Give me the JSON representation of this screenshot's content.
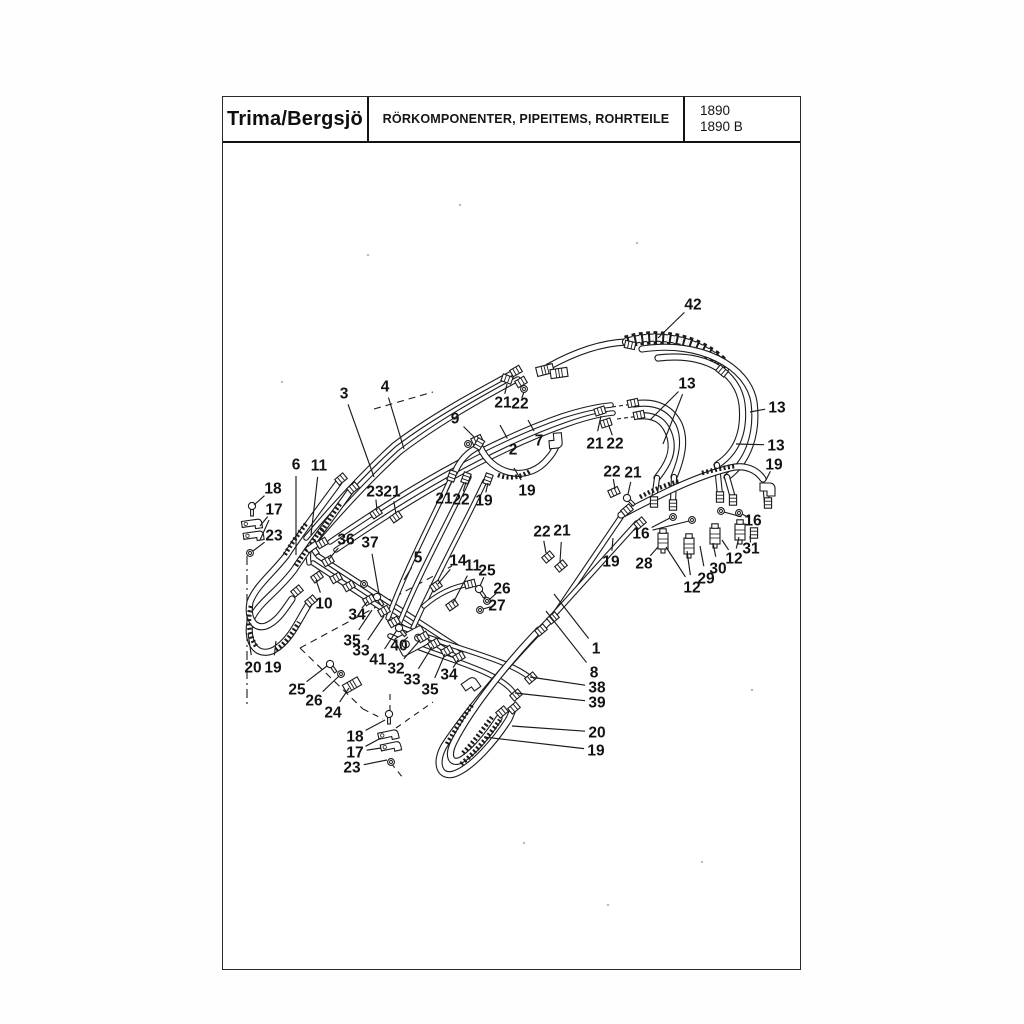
{
  "header": {
    "brand": "Trima/Bergsjö",
    "title": "RÖRKOMPONENTER, PIPEITEMS, ROHRTEILE",
    "model_line1": "1890",
    "model_line2": "1890 B"
  },
  "figure": {
    "description": "Exploded diagram of hydraulic pipe components (pipes, hoses, fittings) with numbered callouts",
    "callouts": [
      {
        "n": "42",
        "x": 693,
        "y": 304,
        "to": [
          [
            658,
            338
          ]
        ]
      },
      {
        "n": "3",
        "x": 344,
        "y": 393,
        "to": [
          [
            374,
            477
          ]
        ]
      },
      {
        "n": "4",
        "x": 385,
        "y": 386,
        "to": [
          [
            404,
            449
          ]
        ]
      },
      {
        "n": "13",
        "x": 687,
        "y": 383,
        "to": [
          [
            650,
            420
          ],
          [
            663,
            444
          ]
        ]
      },
      {
        "n": "13",
        "x": 777,
        "y": 407,
        "to": [
          [
            750,
            412
          ]
        ]
      },
      {
        "n": "13",
        "x": 776,
        "y": 445,
        "to": [
          [
            736,
            444
          ]
        ]
      },
      {
        "n": "19",
        "x": 774,
        "y": 464,
        "to": [
          [
            766,
            480
          ]
        ]
      },
      {
        "n": "21",
        "x": 503,
        "y": 402,
        "to": [
          [
            507,
            384
          ]
        ]
      },
      {
        "n": "22",
        "x": 520,
        "y": 403,
        "to": [
          [
            524,
            392
          ]
        ]
      },
      {
        "n": "9",
        "x": 455,
        "y": 418,
        "to": [
          [
            474,
            437
          ]
        ]
      },
      {
        "n": "2",
        "x": 513,
        "y": 449,
        "to": [
          [
            500,
            425
          ]
        ]
      },
      {
        "n": "7",
        "x": 539,
        "y": 440,
        "to": [
          [
            528,
            420
          ]
        ]
      },
      {
        "n": "21",
        "x": 595,
        "y": 443,
        "to": [
          [
            601,
            416
          ]
        ]
      },
      {
        "n": "22",
        "x": 615,
        "y": 443,
        "to": [
          [
            609,
            426
          ]
        ]
      },
      {
        "n": "19",
        "x": 527,
        "y": 490,
        "to": [
          [
            514,
            468
          ]
        ]
      },
      {
        "n": "6",
        "x": 296,
        "y": 464,
        "to": [
          [
            296,
            555
          ]
        ]
      },
      {
        "n": "11",
        "x": 319,
        "y": 465,
        "to": [
          [
            311,
            535
          ]
        ]
      },
      {
        "n": "18",
        "x": 273,
        "y": 488,
        "to": [
          [
            254,
            505
          ]
        ]
      },
      {
        "n": "17",
        "x": 274,
        "y": 509,
        "to": [
          [
            260,
            526
          ],
          [
            260,
            540
          ]
        ]
      },
      {
        "n": "23",
        "x": 274,
        "y": 535,
        "to": [
          [
            253,
            551
          ]
        ]
      },
      {
        "n": "23",
        "x": 375,
        "y": 491,
        "to": [
          [
            377,
            510
          ]
        ]
      },
      {
        "n": "21",
        "x": 392,
        "y": 491,
        "to": [
          [
            396,
            514
          ]
        ]
      },
      {
        "n": "21",
        "x": 444,
        "y": 498,
        "to": [
          [
            452,
            481
          ]
        ]
      },
      {
        "n": "22",
        "x": 461,
        "y": 499,
        "to": [
          [
            466,
            482
          ]
        ]
      },
      {
        "n": "19",
        "x": 484,
        "y": 500,
        "to": [
          [
            488,
            483
          ]
        ]
      },
      {
        "n": "36",
        "x": 346,
        "y": 539,
        "to": [
          [
            329,
            559
          ]
        ]
      },
      {
        "n": "37",
        "x": 370,
        "y": 542,
        "to": [
          [
            379,
            594
          ]
        ]
      },
      {
        "n": "5",
        "x": 418,
        "y": 557,
        "to": [
          [
            404,
            580
          ]
        ]
      },
      {
        "n": "22",
        "x": 542,
        "y": 531,
        "to": [
          [
            546,
            553
          ]
        ]
      },
      {
        "n": "21",
        "x": 562,
        "y": 530,
        "to": [
          [
            560,
            562
          ]
        ]
      },
      {
        "n": "14",
        "x": 458,
        "y": 560,
        "to": [
          [
            438,
            584
          ]
        ]
      },
      {
        "n": "11",
        "x": 473,
        "y": 565,
        "to": [
          [
            453,
            603
          ]
        ]
      },
      {
        "n": "25",
        "x": 487,
        "y": 570,
        "to": [
          [
            480,
            586
          ]
        ]
      },
      {
        "n": "26",
        "x": 502,
        "y": 588,
        "to": [
          [
            489,
            600
          ]
        ]
      },
      {
        "n": "27",
        "x": 497,
        "y": 605,
        "to": [
          [
            483,
            609
          ]
        ]
      },
      {
        "n": "22",
        "x": 612,
        "y": 471,
        "to": [
          [
            615,
            489
          ]
        ]
      },
      {
        "n": "21",
        "x": 633,
        "y": 472,
        "to": [
          [
            628,
            494
          ]
        ]
      },
      {
        "n": "19",
        "x": 611,
        "y": 561,
        "to": [
          [
            613,
            538
          ]
        ]
      },
      {
        "n": "16",
        "x": 641,
        "y": 533,
        "to": [
          [
            670,
            518
          ],
          [
            689,
            521
          ]
        ]
      },
      {
        "n": "16",
        "x": 753,
        "y": 520,
        "to": [
          [
            742,
            514
          ],
          [
            724,
            512
          ]
        ]
      },
      {
        "n": "31",
        "x": 751,
        "y": 548,
        "to": [
          [
            750,
            536
          ]
        ]
      },
      {
        "n": "28",
        "x": 644,
        "y": 563,
        "to": [
          [
            658,
            547
          ]
        ]
      },
      {
        "n": "12",
        "x": 734,
        "y": 558,
        "to": [
          [
            722,
            540
          ],
          [
            739,
            537
          ]
        ]
      },
      {
        "n": "30",
        "x": 718,
        "y": 568,
        "to": [
          [
            713,
            543
          ]
        ]
      },
      {
        "n": "29",
        "x": 706,
        "y": 578,
        "to": [
          [
            700,
            546
          ]
        ]
      },
      {
        "n": "12",
        "x": 692,
        "y": 587,
        "to": [
          [
            666,
            547
          ],
          [
            687,
            551
          ]
        ]
      },
      {
        "n": "10",
        "x": 324,
        "y": 603,
        "to": [
          [
            316,
            580
          ]
        ]
      },
      {
        "n": "34",
        "x": 357,
        "y": 614,
        "to": [
          [
            368,
            601
          ]
        ]
      },
      {
        "n": "35",
        "x": 352,
        "y": 640,
        "to": [
          [
            372,
            610
          ]
        ]
      },
      {
        "n": "33",
        "x": 361,
        "y": 650,
        "to": [
          [
            384,
            616
          ]
        ]
      },
      {
        "n": "41",
        "x": 378,
        "y": 659,
        "to": [
          [
            397,
            630
          ]
        ]
      },
      {
        "n": "40",
        "x": 399,
        "y": 645,
        "to": [
          [
            408,
            637
          ]
        ]
      },
      {
        "n": "32",
        "x": 396,
        "y": 668,
        "to": [
          [
            420,
            640
          ]
        ]
      },
      {
        "n": "33",
        "x": 412,
        "y": 679,
        "to": [
          [
            432,
            647
          ]
        ]
      },
      {
        "n": "35",
        "x": 430,
        "y": 689,
        "to": [
          [
            445,
            654
          ]
        ]
      },
      {
        "n": "34",
        "x": 449,
        "y": 674,
        "to": [
          [
            458,
            660
          ]
        ]
      },
      {
        "n": "1",
        "x": 596,
        "y": 648,
        "to": [
          [
            554,
            594
          ]
        ]
      },
      {
        "n": "8",
        "x": 594,
        "y": 672,
        "to": [
          [
            546,
            611
          ]
        ]
      },
      {
        "n": "38",
        "x": 597,
        "y": 687,
        "to": [
          [
            530,
            677
          ]
        ]
      },
      {
        "n": "39",
        "x": 597,
        "y": 702,
        "to": [
          [
            515,
            693
          ]
        ]
      },
      {
        "n": "20",
        "x": 597,
        "y": 732,
        "to": [
          [
            512,
            726
          ]
        ]
      },
      {
        "n": "19",
        "x": 596,
        "y": 750,
        "to": [
          [
            484,
            737
          ]
        ]
      },
      {
        "n": "25",
        "x": 297,
        "y": 689,
        "to": [
          [
            327,
            666
          ]
        ]
      },
      {
        "n": "26",
        "x": 314,
        "y": 700,
        "to": [
          [
            339,
            676
          ]
        ]
      },
      {
        "n": "24",
        "x": 333,
        "y": 712,
        "to": [
          [
            349,
            688
          ]
        ]
      },
      {
        "n": "18",
        "x": 355,
        "y": 736,
        "to": [
          [
            385,
            720
          ]
        ]
      },
      {
        "n": "17",
        "x": 355,
        "y": 752,
        "to": [
          [
            381,
            738
          ],
          [
            381,
            748
          ]
        ]
      },
      {
        "n": "23",
        "x": 352,
        "y": 767,
        "to": [
          [
            387,
            760
          ]
        ]
      },
      {
        "n": "20",
        "x": 253,
        "y": 667,
        "to": [
          [
            248,
            633
          ]
        ]
      },
      {
        "n": "19",
        "x": 273,
        "y": 667,
        "to": [
          [
            276,
            641
          ]
        ]
      }
    ]
  }
}
